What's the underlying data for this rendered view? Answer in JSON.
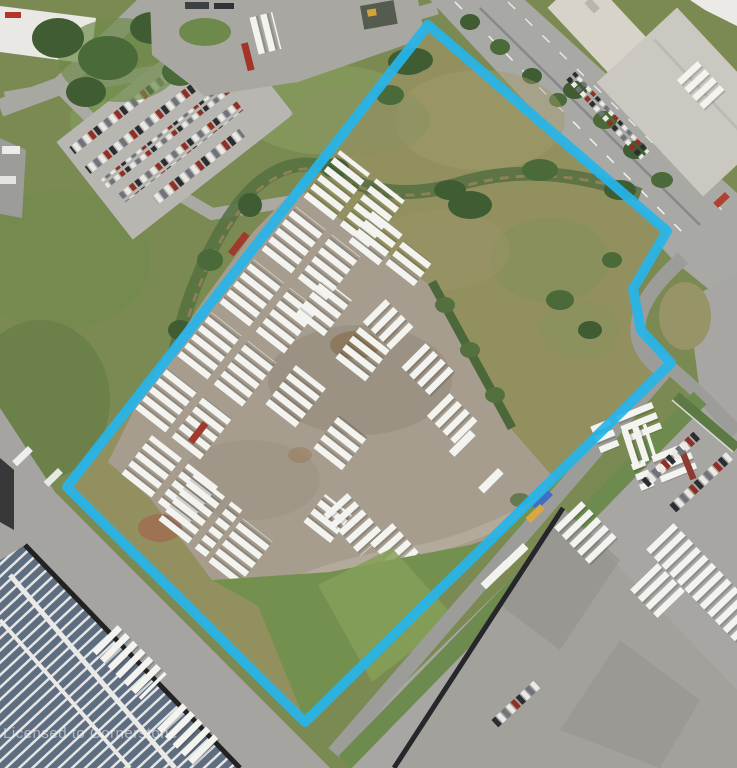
{
  "watermark": {
    "text": "Licensed to Cornerstone"
  },
  "map": {
    "kind": "satellite-aerial-photo",
    "subject": "vacant industrial parcel with trailer storage yard outlined by highlighted property boundary",
    "boundary": {
      "color": "#27b5e9",
      "stroke_width": 10,
      "points": "428,25 667,231 633,289 641,330 671,363 305,722 67,487"
    },
    "palette": {
      "boundary_cyan": "#27b5e9",
      "grass": "#7b8a52",
      "field_green": "#74904f",
      "scrub_olive": "#93905f",
      "gravel_yard": "#a69d8f",
      "road_gray": "#a8a8a4",
      "pavement_gray": "#a7a6a2",
      "trailer_white": "#f3f3f0",
      "warehouse_roof_gray": "#a3a19c",
      "warehouse_roof_white": "#dedede",
      "solar_panel_blue": "#5e6e80",
      "tree_green": "#3f5c33",
      "dirt_red": "#a06a50"
    }
  }
}
